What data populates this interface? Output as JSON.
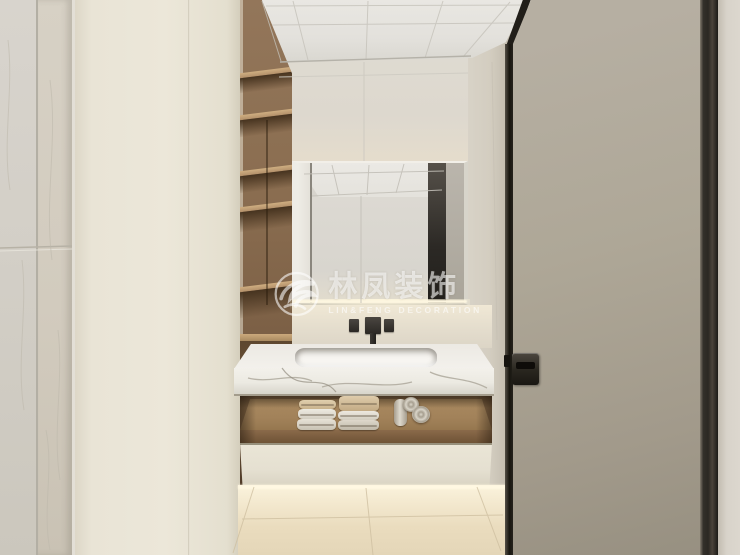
{
  "watermark": {
    "brand_cn": "林凤装饰",
    "brand_en": "LIN&FENG DECORATION",
    "color": "#ffffff",
    "opacity": 0.58
  },
  "scene": {
    "type": "interior-3d-render",
    "room": "bathroom vanity alcove with open door",
    "elements": [
      "gray marble wall tiles",
      "cream storage cabinet",
      "walnut open shelving column",
      "grid panel ceiling",
      "backlit rectangular mirror",
      "wall-mounted black faucet with two handles",
      "white marble countertop with integrated basin",
      "towel niche with folded and rolled towels",
      "cream drawer front",
      "beige marble floor with under-cabinet glow",
      "taupe door with dark bronze frame and flush handle"
    ]
  },
  "palette": {
    "marble_wall": "#d6d1c8",
    "cabinet_cream": "#e9e4d6",
    "wood_shelf": "#8a6d50",
    "ceiling": "#e6e4df",
    "mirror_glow": "#fdf4dd",
    "countertop": "#f2f0ea",
    "towel_beige": "#d8c5a4",
    "door_panel": "#aaa294",
    "door_frame": "#2b2823",
    "floor": "#eee3c8"
  }
}
